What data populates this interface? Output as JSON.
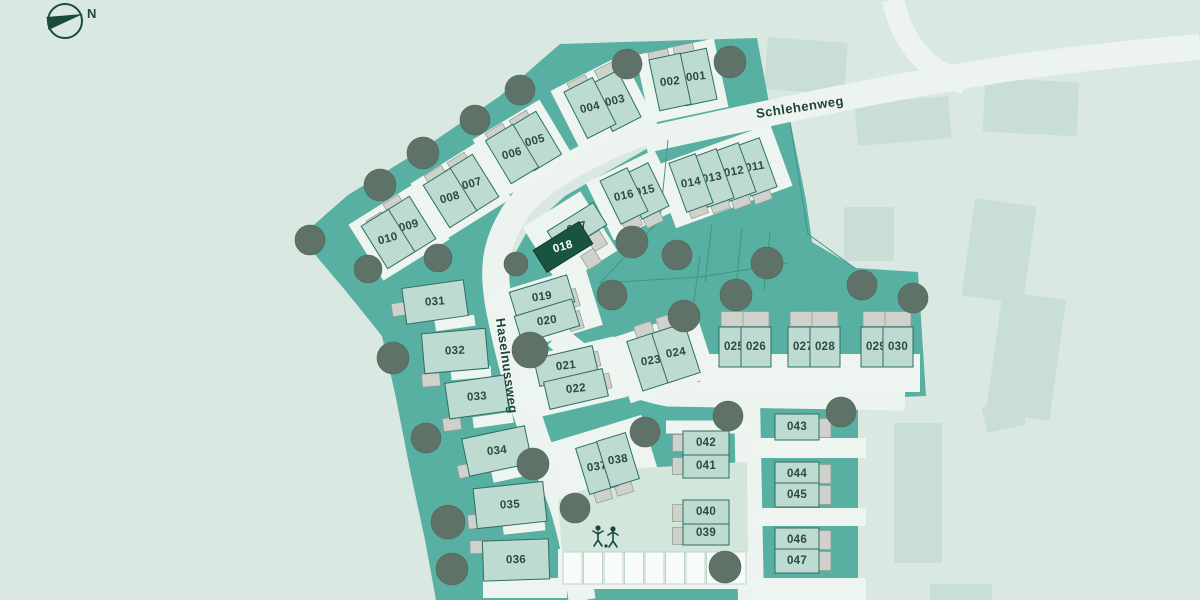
{
  "compass": {
    "label": "N"
  },
  "streets": {
    "schlehenweg": {
      "name": "Schlehenweg"
    },
    "haselnussweg": {
      "name": "Haselnussweg"
    }
  },
  "highlighted_plot": "018",
  "colors": {
    "background": "#d9e8e1",
    "development": "#58b0a2",
    "house": "#bddbd1",
    "highlight": "#195441",
    "road": "#edf4f0",
    "existing_building": "#c9dfd5",
    "garage": "#ced2cb",
    "tree": "#5e7268",
    "text": "#2b4a44"
  },
  "plots": [
    [
      "001",
      696,
      77,
      32,
      52,
      -12
    ],
    [
      "002",
      670,
      82,
      32,
      52,
      -12
    ],
    [
      "003",
      615,
      101,
      32,
      52,
      -27
    ],
    [
      "004",
      590,
      108,
      32,
      52,
      -27
    ],
    [
      "005",
      535,
      141,
      32,
      50,
      -31
    ],
    [
      "006",
      512,
      154,
      32,
      50,
      -31
    ],
    [
      "007",
      472,
      184,
      32,
      50,
      -32
    ],
    [
      "008",
      450,
      198,
      32,
      50,
      -32
    ],
    [
      "009",
      409,
      226,
      32,
      50,
      -32
    ],
    [
      "010",
      388,
      239,
      32,
      50,
      -32
    ],
    [
      "011",
      755,
      167,
      28,
      52,
      -20
    ],
    [
      "012",
      734,
      172,
      28,
      52,
      -20
    ],
    [
      "013",
      712,
      178,
      28,
      52,
      -20
    ],
    [
      "014",
      691,
      183,
      28,
      52,
      -20
    ],
    [
      "015",
      645,
      191,
      30,
      48,
      -26
    ],
    [
      "016",
      624,
      196,
      30,
      48,
      -26
    ],
    [
      "017",
      577,
      228,
      54,
      26,
      -32
    ],
    [
      "018",
      563,
      247,
      54,
      26,
      -32
    ],
    [
      "019",
      542,
      297,
      60,
      28,
      -17
    ],
    [
      "020",
      547,
      321,
      60,
      28,
      -17
    ],
    [
      "021",
      566,
      366,
      60,
      28,
      -13
    ],
    [
      "022",
      576,
      389,
      60,
      28,
      -13
    ],
    [
      "023",
      651,
      361,
      34,
      52,
      -18
    ],
    [
      "024",
      676,
      353,
      34,
      52,
      -18
    ],
    [
      "025",
      734,
      347,
      30,
      40,
      0
    ],
    [
      "026",
      756,
      347,
      30,
      40,
      0
    ],
    [
      "027",
      803,
      347,
      30,
      40,
      0
    ],
    [
      "028",
      825,
      347,
      30,
      40,
      0
    ],
    [
      "029",
      876,
      347,
      30,
      40,
      0
    ],
    [
      "030",
      898,
      347,
      30,
      40,
      0
    ],
    [
      "031",
      435,
      302,
      62,
      36,
      -8
    ],
    [
      "032",
      455,
      351,
      64,
      40,
      -5
    ],
    [
      "033",
      477,
      397,
      60,
      36,
      -8
    ],
    [
      "034",
      497,
      451,
      64,
      38,
      -12
    ],
    [
      "035",
      510,
      505,
      70,
      40,
      -6
    ],
    [
      "036",
      516,
      560,
      66,
      40,
      -2
    ],
    [
      "037",
      597,
      467,
      30,
      48,
      -17
    ],
    [
      "038",
      618,
      460,
      30,
      48,
      -17
    ],
    [
      "039",
      706,
      533,
      46,
      24,
      0
    ],
    [
      "040",
      706,
      512,
      46,
      24,
      0
    ],
    [
      "041",
      706,
      466,
      46,
      24,
      0
    ],
    [
      "042",
      706,
      443,
      46,
      24,
      0
    ],
    [
      "043",
      797,
      427,
      44,
      26,
      0
    ],
    [
      "044",
      797,
      474,
      44,
      24,
      0
    ],
    [
      "045",
      797,
      495,
      44,
      24,
      0
    ],
    [
      "046",
      797,
      540,
      44,
      24,
      0
    ],
    [
      "047",
      797,
      561,
      44,
      24,
      0
    ]
  ],
  "garages": [
    [
      659,
      57,
      20,
      13,
      -12
    ],
    [
      684,
      51,
      20,
      13,
      -12
    ],
    [
      579,
      85,
      20,
      13,
      -27
    ],
    [
      606,
      72,
      20,
      13,
      -27
    ],
    [
      497,
      134,
      20,
      13,
      -31
    ],
    [
      521,
      121,
      20,
      13,
      -31
    ],
    [
      436,
      176,
      20,
      13,
      -32
    ],
    [
      459,
      163,
      20,
      13,
      -32
    ],
    [
      394,
      205,
      18,
      13,
      -32
    ],
    [
      377,
      222,
      18,
      13,
      -32
    ],
    [
      698,
      210,
      18,
      12,
      -20
    ],
    [
      720,
      205,
      18,
      12,
      -20
    ],
    [
      741,
      201,
      18,
      12,
      -20
    ],
    [
      762,
      196,
      18,
      12,
      -20
    ],
    [
      632,
      223,
      18,
      12,
      -26
    ],
    [
      653,
      219,
      18,
      12,
      -26
    ],
    [
      597,
      241,
      15,
      16,
      -32
    ],
    [
      591,
      259,
      15,
      16,
      -32
    ],
    [
      571,
      299,
      14,
      18,
      -17
    ],
    [
      575,
      321,
      14,
      18,
      -17
    ],
    [
      592,
      360,
      15,
      15,
      -13
    ],
    [
      603,
      382,
      15,
      15,
      -13
    ],
    [
      644,
      330,
      18,
      13,
      -18
    ],
    [
      666,
      322,
      18,
      13,
      -18
    ],
    [
      734,
      319,
      26,
      15,
      0
    ],
    [
      756,
      319,
      26,
      15,
      0
    ],
    [
      803,
      319,
      26,
      15,
      0
    ],
    [
      825,
      319,
      26,
      15,
      0
    ],
    [
      876,
      319,
      26,
      15,
      0
    ],
    [
      898,
      319,
      26,
      15,
      0
    ],
    [
      401,
      309,
      18,
      13,
      -8
    ],
    [
      431,
      380,
      18,
      13,
      -5
    ],
    [
      452,
      424,
      18,
      13,
      -8
    ],
    [
      469,
      470,
      22,
      13,
      -12
    ],
    [
      479,
      521,
      22,
      14,
      -6
    ],
    [
      480,
      547,
      20,
      13,
      -2
    ],
    [
      603,
      495,
      17,
      12,
      -17
    ],
    [
      624,
      488,
      17,
      12,
      -17
    ],
    [
      680,
      443,
      15,
      17,
      0
    ],
    [
      680,
      466,
      15,
      17,
      0
    ],
    [
      680,
      513,
      15,
      17,
      0
    ],
    [
      680,
      536,
      15,
      17,
      0
    ],
    [
      824,
      428,
      14,
      19,
      0
    ],
    [
      824,
      474,
      14,
      19,
      0
    ],
    [
      824,
      495,
      14,
      19,
      0
    ],
    [
      824,
      540,
      14,
      19,
      0
    ],
    [
      824,
      561,
      14,
      19,
      0
    ]
  ],
  "pockets": [
    [
      682,
      81,
      80,
      70,
      -12
    ],
    [
      602,
      104,
      80,
      70,
      -27
    ],
    [
      523,
      148,
      78,
      66,
      -31
    ],
    [
      461,
      191,
      78,
      66,
      -32
    ],
    [
      399,
      232,
      78,
      66,
      -32
    ],
    [
      723,
      176,
      124,
      66,
      -20
    ],
    [
      634,
      195,
      76,
      64,
      -26
    ],
    [
      570,
      239,
      68,
      70,
      -32
    ],
    [
      545,
      310,
      102,
      62,
      -17
    ],
    [
      571,
      378,
      102,
      62,
      -13
    ],
    [
      663,
      357,
      90,
      68,
      -18
    ],
    [
      607,
      464,
      94,
      74,
      -17
    ],
    [
      810,
      373,
      220,
      38,
      0
    ],
    [
      455,
      323,
      40,
      11,
      -8
    ],
    [
      471,
      373,
      40,
      11,
      -5
    ],
    [
      493,
      420,
      40,
      11,
      -8
    ],
    [
      513,
      473,
      42,
      11,
      -12
    ],
    [
      524,
      527,
      42,
      11,
      -6
    ],
    [
      525,
      588,
      84,
      20,
      0
    ],
    [
      707,
      427,
      82,
      13,
      0
    ],
    [
      707,
      490,
      82,
      24,
      0
    ],
    [
      697,
      566,
      62,
      28,
      0
    ],
    [
      810,
      448,
      112,
      20,
      0
    ],
    [
      810,
      517,
      112,
      18,
      0
    ],
    [
      810,
      589,
      112,
      22,
      0
    ],
    [
      654,
      569,
      192,
      40,
      0
    ]
  ],
  "parcel_lines": [
    [
      668,
      140,
      660,
      220
    ],
    [
      660,
      220,
      600,
      283
    ],
    [
      600,
      283,
      700,
      277
    ],
    [
      700,
      277,
      788,
      263
    ],
    [
      790,
      122,
      808,
      234
    ],
    [
      808,
      234,
      856,
      269
    ],
    [
      700,
      256,
      694,
      302
    ],
    [
      712,
      224,
      705,
      282
    ],
    [
      742,
      228,
      736,
      286
    ],
    [
      770,
      232,
      764,
      290
    ]
  ],
  "trees": [
    [
      627,
      64,
      15
    ],
    [
      730,
      62,
      16
    ],
    [
      520,
      90,
      15
    ],
    [
      475,
      120,
      15
    ],
    [
      423,
      153,
      16
    ],
    [
      380,
      185,
      16
    ],
    [
      310,
      240,
      15
    ],
    [
      368,
      269,
      14
    ],
    [
      438,
      258,
      14
    ],
    [
      632,
      242,
      16
    ],
    [
      677,
      255,
      15
    ],
    [
      767,
      263,
      16
    ],
    [
      612,
      295,
      15
    ],
    [
      684,
      316,
      16
    ],
    [
      736,
      295,
      16
    ],
    [
      862,
      285,
      15
    ],
    [
      913,
      298,
      15
    ],
    [
      516,
      264,
      12
    ],
    [
      530,
      350,
      18
    ],
    [
      393,
      358,
      16
    ],
    [
      426,
      438,
      15
    ],
    [
      533,
      464,
      16
    ],
    [
      448,
      522,
      17
    ],
    [
      452,
      569,
      16
    ],
    [
      575,
      508,
      15
    ],
    [
      645,
      432,
      15
    ],
    [
      728,
      416,
      15
    ],
    [
      725,
      567,
      16
    ],
    [
      841,
      412,
      15
    ]
  ],
  "existing_buildings": [
    [
      806,
      66,
      80,
      52,
      4
    ],
    [
      903,
      121,
      94,
      42,
      -5
    ],
    [
      1031,
      107,
      94,
      54,
      3
    ],
    [
      869,
      234,
      50,
      54,
      0
    ],
    [
      999,
      251,
      62,
      98,
      8
    ],
    [
      1026,
      356,
      64,
      122,
      8
    ],
    [
      918,
      493,
      48,
      140,
      0
    ],
    [
      1004,
      416,
      40,
      26,
      -12
    ],
    [
      961,
      592,
      62,
      16,
      0
    ]
  ],
  "parking": {
    "x": 563,
    "y": 552,
    "count": 9,
    "stall_w": 20.5,
    "stall_h": 32
  }
}
